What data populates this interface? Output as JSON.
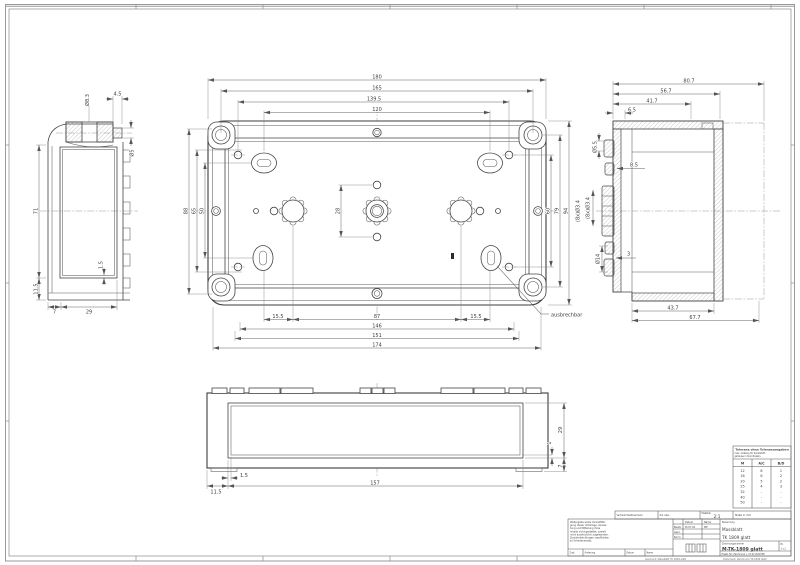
{
  "sheet": {
    "footer_left": "Ausdruck: Massblatt TK 1809 glatt",
    "footer_right": "Dokument: Zeichnung TK 1809 glatt"
  },
  "top_view": {
    "d180": "180",
    "d165": "165",
    "d139_5": "139.5",
    "d120": "120",
    "d15_5a": "15.5",
    "d87": "87",
    "d15_5b": "15.5",
    "d146": "146",
    "d151": "151",
    "d174": "174",
    "d50": "50",
    "d65": "65",
    "d88": "88",
    "d60": "60",
    "d79": "79",
    "d94": "94",
    "d28": "28",
    "holes": "(8x)Ø3.4",
    "callout": "ausbrechbar"
  },
  "left_view": {
    "d83": "Ø8.3",
    "d45": "4.5",
    "d5": "Ø5",
    "d71": "71",
    "d11_5": "11.5",
    "d7": "7",
    "d29": "29",
    "d1_5": "1.5"
  },
  "right_view": {
    "d80_7": "80.7",
    "d56_7": "56.7",
    "d41_7": "41.7",
    "d6_5": "6.5",
    "d43_7": "43.7",
    "d67_7": "67.7",
    "d5_5": "Ø5.5",
    "d8_5": "8.5",
    "holes": "(8x)Ø3.4",
    "d14": "Ø14",
    "d3": "3"
  },
  "front_view": {
    "d11_5": "11.5",
    "d1_5": "1.5",
    "d157": "157",
    "d29": "29",
    "d7": "7",
    "d1": "1"
  },
  "tolerance_table": {
    "title": "Toleranz ohne Toleranzangaben",
    "subtitle1": "max. zulässig für Kunststoff-",
    "subtitle2": "gehäuse in Koordinaten",
    "col_m": "M",
    "col_ac": "A/C",
    "col_bd": "B/D",
    "rows": [
      {
        "m": "12",
        "ac": "8",
        "bd": "1"
      },
      {
        "m": "16",
        "ac": "6",
        "bd": "2"
      },
      {
        "m": "20",
        "ac": "5",
        "bd": "2"
      },
      {
        "m": "25",
        "ac": "4",
        "bd": "3"
      },
      {
        "m": "32",
        "ac": "-",
        "bd": "-"
      },
      {
        "m": "40",
        "ac": "-",
        "bd": "-"
      },
      {
        "m": "50",
        "ac": "-",
        "bd": "-"
      }
    ]
  },
  "title_block": {
    "confidential_label": "Vertraulichkeitsvermerk",
    "tol_label": "Zul. Abw.",
    "scale_label": "Maßstab",
    "scale_value": "2:1",
    "units_label": "Maße in mm",
    "copyright_lines": [
      "Weitergabe sowie Vervielfälti-",
      "gung dieser Unterlage, Verwer-",
      "tung und Mitteilung ihres",
      "Inhalts nicht gestattet, soweit",
      "nicht ausdrücklich zugestanden.",
      "Zuwiderhandlungen verpflichten",
      "zu Schadenersatz."
    ],
    "approval": {
      "col_date": "Datum",
      "col_name": "Name",
      "bearb_label": "Bearb.",
      "bearb_date": "15.07.02",
      "bearb_name": "ME",
      "gepr_label": "Gepr.",
      "norm_label": "Norm"
    },
    "name_label": "Benennung",
    "name_line1": "Massblatt",
    "name_line2": "TK 1809 glatt",
    "number_label": "Zeichnungsnummer",
    "number_value": "M-TK-1809 glatt",
    "sheet_label": "Bl.",
    "sheet_value": "1 v.1",
    "rev": {
      "zust": "Zust.",
      "aenderung": "Änderung",
      "datum": "Datum",
      "name": "Name"
    },
    "replacement": "Ersatz für: Zeichnung v. 15.07.2002 ME"
  }
}
